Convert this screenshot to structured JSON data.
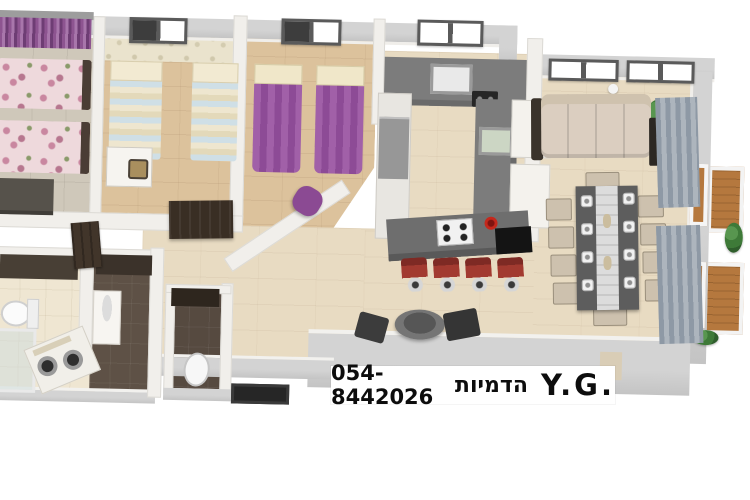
{
  "watermark": {
    "phone": "054-8442026",
    "studio_he": "הדמיות",
    "initials": "Y.G."
  },
  "palette": {
    "background": "#ffffff",
    "wall_outer": "#c8c8c8",
    "wall_inner": "#f1efeb",
    "floor_wood_light": "#e8dbc2",
    "floor_wood_mid": "#dcc29c",
    "floor_tile_gray": "#cfc8ba",
    "floor_tile_dark": "#5e5146",
    "floor_tile_cream": "#efe6d2",
    "bed_purple": "#9b57a1",
    "bed_floral_pink": "#eed9dc",
    "bed_stripe_blue": "#cfdfe6",
    "kitchen_counter": "#787878",
    "island_gray": "#6e6e6e",
    "stool_red": "#a23a30",
    "kettle_red": "#c4281c",
    "sofa_beige": "#dbcec0",
    "dining_table": "#5d5d5d",
    "curtain_gray_blue": "#8e99a5",
    "curtain_purple": "#8d5490",
    "deck_wood": "#b5783e",
    "plant_green": "#3e7a38",
    "dark_furniture": "#392e24",
    "text": "#0d0d0d"
  },
  "scene": {
    "type": "3d-floorplan-top-view",
    "rooms": [
      {
        "name": "bedroom-1",
        "items": [
          "floral-bed",
          "floral-bed",
          "dresser",
          "purple-curtain-window"
        ]
      },
      {
        "name": "bedroom-2",
        "items": [
          "twin-bed",
          "twin-bed",
          "desk",
          "chair",
          "wardrobe",
          "window"
        ]
      },
      {
        "name": "bedroom-3",
        "items": [
          "purple-bed",
          "purple-bed",
          "beanbag",
          "window",
          "diagonal-wall"
        ]
      },
      {
        "name": "kitchen",
        "items": [
          "l-counter",
          "sink",
          "sink",
          "cooktop",
          "fridge",
          "island",
          "gas-hob",
          "kettle",
          "bar-stool",
          "bar-stool",
          "bar-stool",
          "bar-stool"
        ]
      },
      {
        "name": "living-dining",
        "items": [
          "sofa",
          "side-table",
          "plant",
          "dining-table",
          "ten-chairs",
          "runner",
          "plates",
          "curtains",
          "round-table",
          "two-chairs",
          "windows"
        ]
      },
      {
        "name": "hallway",
        "items": [
          "entrance-mat",
          "doors"
        ]
      },
      {
        "name": "bathroom",
        "items": [
          "vanity",
          "dark-tiles"
        ]
      },
      {
        "name": "laundry-bathroom",
        "items": [
          "toilet",
          "shower",
          "washer",
          "dryer"
        ]
      },
      {
        "name": "wc",
        "items": [
          "toilet",
          "dark-tiles"
        ]
      },
      {
        "name": "balcony-deck",
        "items": [
          "wood-deck",
          "plants"
        ]
      }
    ]
  }
}
